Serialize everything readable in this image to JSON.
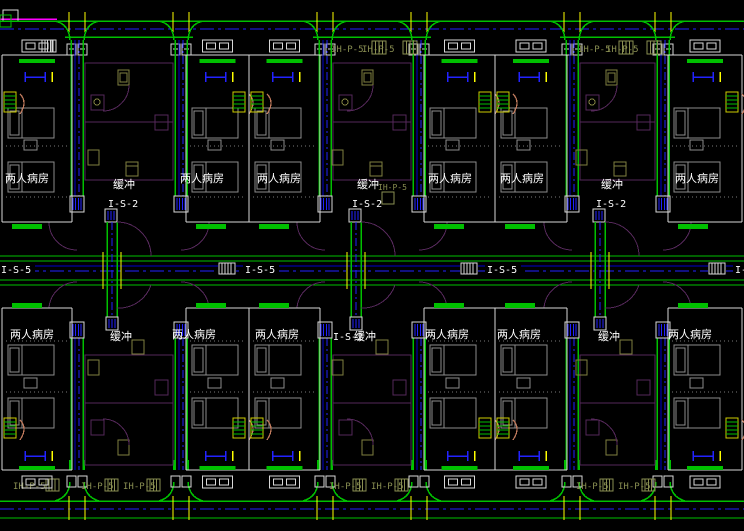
{
  "labels": {
    "ward_room": "两人病房",
    "buffer": "缓冲",
    "branch_duct": "I-S-2",
    "corridor_duct": "I-S-5",
    "supply_duct": "IH-P-5"
  },
  "rooms": {
    "top": [
      "两人病房",
      "两人病房",
      "两人病房",
      "两人病房",
      "两人病房",
      "两人病房"
    ],
    "bottom": [
      "两人病房",
      "两人病房",
      "两人病房",
      "两人病房",
      "两人病房",
      "两人病房"
    ]
  },
  "corridor": {
    "centerline_labels": [
      "I-S-5",
      "I-S-5",
      "I-S-5",
      "I-S-5"
    ]
  },
  "colors": {
    "background": "#000000",
    "wall_green": "#00c000",
    "axis_blue": "#2222ff",
    "line_blue": "#0000cc",
    "wall_white": "#d8d8d8",
    "text_white": "#ffffff",
    "furniture_gray": "#8c8c8c",
    "dotted_gray": "#7a7a7a",
    "partition_purple": "#55285a",
    "fixture_olive": "#7f8040",
    "label_olive": "#8a8f52",
    "grid_yellow": "#ffff00",
    "accent_magenta": "#ff00ff",
    "door_salmon": "#c27b5e"
  }
}
